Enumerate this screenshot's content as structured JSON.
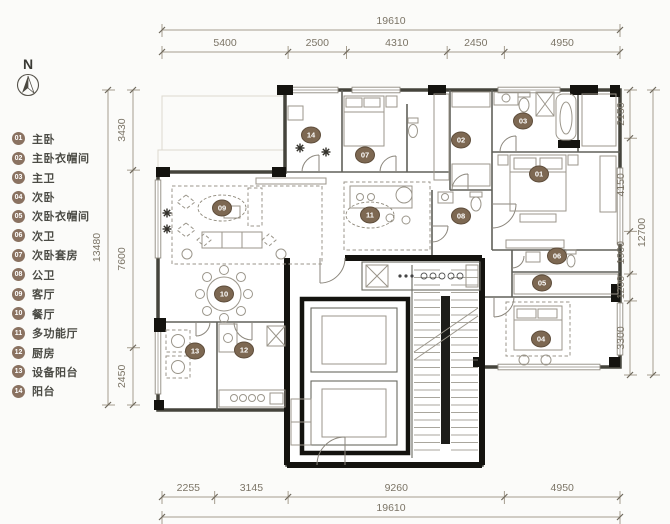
{
  "meta": {
    "drawing_type": "apartment floor plan",
    "colors": {
      "accent_brown": "#8a7261",
      "dim_text": "#7b7466",
      "wall": "#45443c",
      "core_wall": "#14130f"
    }
  },
  "north": {
    "label": "N"
  },
  "rooms": [
    {
      "num": "01",
      "label": "主卧",
      "x": 539,
      "y": 174,
      "halo": false
    },
    {
      "num": "02",
      "label": "主卧衣帽间",
      "x": 461,
      "y": 140,
      "halo": false
    },
    {
      "num": "03",
      "label": "主卫",
      "x": 523,
      "y": 121,
      "halo": false
    },
    {
      "num": "04",
      "label": "次卧",
      "x": 541,
      "y": 339,
      "halo": false
    },
    {
      "num": "05",
      "label": "次卧衣帽间",
      "x": 542,
      "y": 283,
      "halo": false
    },
    {
      "num": "06",
      "label": "次卫",
      "x": 557,
      "y": 256,
      "halo": false
    },
    {
      "num": "07",
      "label": "次卧套房",
      "x": 365,
      "y": 155,
      "halo": false
    },
    {
      "num": "08",
      "label": "公卫",
      "x": 461,
      "y": 216,
      "halo": false
    },
    {
      "num": "09",
      "label": "客厅",
      "x": 222,
      "y": 208,
      "halo": true
    },
    {
      "num": "10",
      "label": "餐厅",
      "x": 224,
      "y": 294,
      "halo": false
    },
    {
      "num": "11",
      "label": "多功能厅",
      "x": 370,
      "y": 215,
      "halo": true
    },
    {
      "num": "12",
      "label": "厨房",
      "x": 244,
      "y": 350,
      "halo": false
    },
    {
      "num": "13",
      "label": "设备阳台",
      "x": 195,
      "y": 351,
      "halo": false
    },
    {
      "num": "14",
      "label": "阳台",
      "x": 311,
      "y": 135,
      "halo": false
    }
  ],
  "dimensions": {
    "top": {
      "total": "19610",
      "segments": [
        "5400",
        "2500",
        "4310",
        "2450",
        "4950"
      ]
    },
    "bottom": {
      "total": "19610",
      "segments": [
        "2255",
        "3145",
        "9260",
        "4950"
      ]
    },
    "left": {
      "total": "13480",
      "segments": [
        "3430",
        "7600",
        "2450"
      ]
    },
    "right": {
      "total": "12700",
      "segments": [
        "2150",
        "4150",
        "1900",
        "1200",
        "3300"
      ]
    }
  }
}
